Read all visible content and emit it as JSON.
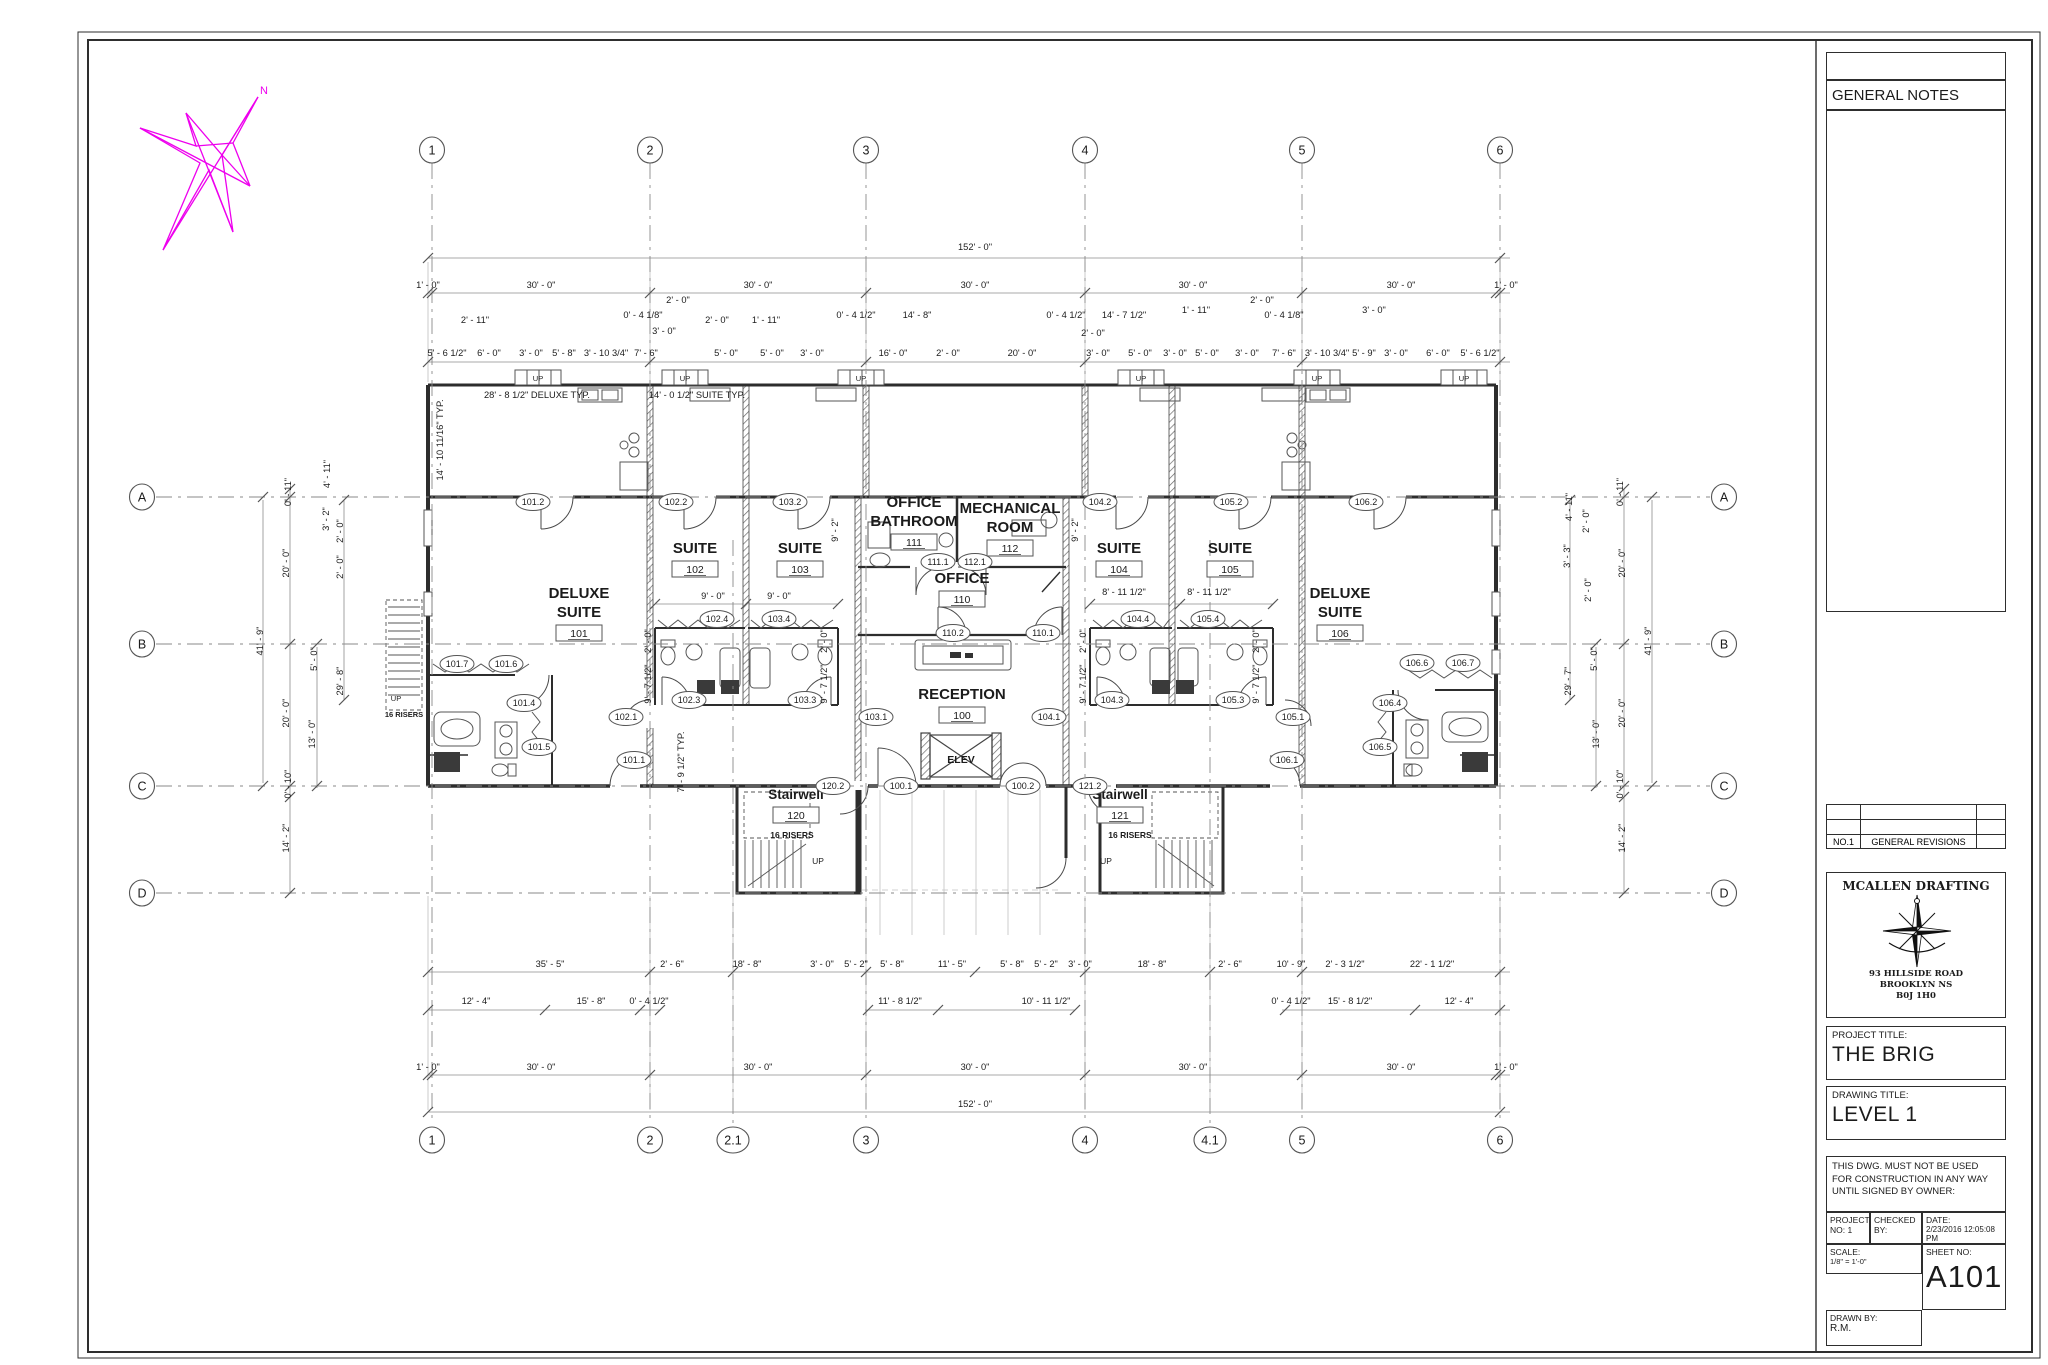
{
  "title_block": {
    "general_notes": "GENERAL NOTES",
    "revisions": {
      "no": "NO.1",
      "desc": "GENERAL REVISIONS"
    },
    "firm": {
      "name": "MCALLEN DRAFTING",
      "address1": "93 HILLSIDE ROAD",
      "address2": "BROOKLYN NS",
      "address3": "B0J 1H0"
    },
    "project_title_label": "PROJECT TITLE:",
    "project_title": "THE BRIG",
    "drawing_title_label": "DRAWING TITLE:",
    "drawing_title": "LEVEL 1",
    "disclaimer": "THIS DWG. MUST NOT BE USED FOR CONSTRUCTION IN ANY WAY UNTIL SIGNED BY OWNER:",
    "project_no_label": "PROJECT NO: 1",
    "checked_by_label": "CHECKED BY:",
    "date_label": "DATE:",
    "date": "2/23/2016 12:05:08 PM",
    "scale_label": "SCALE:",
    "scale": "1/8\" = 1'-0\"",
    "sheet_no_label": "SHEET NO:",
    "sheet_no": "A101",
    "drawn_by_label": "DRAWN BY:",
    "drawn_by": "R.M."
  },
  "plan": {
    "north_label": "N",
    "grid_cols": [
      {
        "label": "1",
        "x": 432
      },
      {
        "label": "2",
        "x": 650
      },
      {
        "label": "2.1",
        "x": 733,
        "bottom_only": true
      },
      {
        "label": "3",
        "x": 866
      },
      {
        "label": "4",
        "x": 1085
      },
      {
        "label": "4.1",
        "x": 1210,
        "bottom_only": true
      },
      {
        "label": "5",
        "x": 1302
      },
      {
        "label": "6",
        "x": 1500
      }
    ],
    "grid_rows": [
      {
        "label": "A",
        "y": 497
      },
      {
        "label": "B",
        "y": 644
      },
      {
        "label": "C",
        "y": 786
      },
      {
        "label": "D",
        "y": 893
      }
    ],
    "rooms": [
      {
        "name": [
          "DELUXE",
          "SUITE"
        ],
        "num": "101",
        "x": 579,
        "y": 598
      },
      {
        "name": [
          "SUITE"
        ],
        "num": "102",
        "x": 695,
        "y": 553
      },
      {
        "name": [
          "SUITE"
        ],
        "num": "103",
        "x": 800,
        "y": 553
      },
      {
        "name": [
          "OFFICE",
          "BATHROOM"
        ],
        "num": "111",
        "x": 914,
        "y": 507
      },
      {
        "name": [
          "MECHANICAL",
          "ROOM"
        ],
        "num": "112",
        "x": 1010,
        "y": 513
      },
      {
        "name": [
          "OFFICE"
        ],
        "num": "110",
        "x": 962,
        "y": 583
      },
      {
        "name": [
          "RECEPTION"
        ],
        "num": "100",
        "x": 962,
        "y": 699
      },
      {
        "name": [
          "SUITE"
        ],
        "num": "104",
        "x": 1119,
        "y": 553
      },
      {
        "name": [
          "SUITE"
        ],
        "num": "105",
        "x": 1230,
        "y": 553
      },
      {
        "name": [
          "DELUXE",
          "SUITE"
        ],
        "num": "106",
        "x": 1340,
        "y": 598
      },
      {
        "name": [
          "Stairwell"
        ],
        "num": "120",
        "x": 796,
        "y": 799,
        "small": true
      },
      {
        "name": [
          "Stairwell"
        ],
        "num": "121",
        "x": 1120,
        "y": 799,
        "small": true
      }
    ],
    "tags": [
      {
        "t": "101.2",
        "x": 533,
        "y": 502
      },
      {
        "t": "102.2",
        "x": 676,
        "y": 502
      },
      {
        "t": "103.2",
        "x": 790,
        "y": 502
      },
      {
        "t": "104.2",
        "x": 1100,
        "y": 502
      },
      {
        "t": "105.2",
        "x": 1231,
        "y": 502
      },
      {
        "t": "106.2",
        "x": 1366,
        "y": 502
      },
      {
        "t": "101.7",
        "x": 457,
        "y": 664
      },
      {
        "t": "101.6",
        "x": 506,
        "y": 664
      },
      {
        "t": "101.4",
        "x": 524,
        "y": 703
      },
      {
        "t": "101.5",
        "x": 539,
        "y": 747
      },
      {
        "t": "101.1",
        "x": 634,
        "y": 760
      },
      {
        "t": "102.1",
        "x": 626,
        "y": 717
      },
      {
        "t": "102.4",
        "x": 717,
        "y": 619
      },
      {
        "t": "103.4",
        "x": 779,
        "y": 619
      },
      {
        "t": "102.3",
        "x": 689,
        "y": 700
      },
      {
        "t": "103.3",
        "x": 805,
        "y": 700
      },
      {
        "t": "111.1",
        "x": 938,
        "y": 562
      },
      {
        "t": "112.1",
        "x": 975,
        "y": 562
      },
      {
        "t": "110.2",
        "x": 953,
        "y": 633
      },
      {
        "t": "110.1",
        "x": 1043,
        "y": 633
      },
      {
        "t": "103.1",
        "x": 876,
        "y": 717
      },
      {
        "t": "104.1",
        "x": 1049,
        "y": 717
      },
      {
        "t": "104.4",
        "x": 1138,
        "y": 619
      },
      {
        "t": "105.4",
        "x": 1208,
        "y": 619
      },
      {
        "t": "104.3",
        "x": 1112,
        "y": 700
      },
      {
        "t": "105.3",
        "x": 1233,
        "y": 700
      },
      {
        "t": "105.1",
        "x": 1293,
        "y": 717
      },
      {
        "t": "106.1",
        "x": 1287,
        "y": 760
      },
      {
        "t": "106.4",
        "x": 1390,
        "y": 703
      },
      {
        "t": "106.5",
        "x": 1380,
        "y": 747
      },
      {
        "t": "106.6",
        "x": 1417,
        "y": 663
      },
      {
        "t": "106.7",
        "x": 1463,
        "y": 663
      },
      {
        "t": "120.2",
        "x": 833,
        "y": 786
      },
      {
        "t": "100.1",
        "x": 901,
        "y": 786
      },
      {
        "t": "100.2",
        "x": 1023,
        "y": 786
      },
      {
        "t": "121.2",
        "x": 1090,
        "y": 786
      }
    ],
    "dims": [
      {
        "t": "152' - 0\"",
        "x": 975,
        "y": 250
      },
      {
        "t": "1' - 0\"",
        "x": 428,
        "y": 288
      },
      {
        "t": "30' - 0\"",
        "x": 541,
        "y": 288
      },
      {
        "t": "30' - 0\"",
        "x": 758,
        "y": 288
      },
      {
        "t": "30' - 0\"",
        "x": 975,
        "y": 288
      },
      {
        "t": "30' - 0\"",
        "x": 1193,
        "y": 288
      },
      {
        "t": "30' - 0\"",
        "x": 1401,
        "y": 288
      },
      {
        "t": "1' - 0\"",
        "x": 1506,
        "y": 288
      },
      {
        "t": "5' - 6 1/2\"",
        "x": 447,
        "y": 356
      },
      {
        "t": "6' - 0\"",
        "x": 489,
        "y": 356
      },
      {
        "t": "3' - 0\"",
        "x": 531,
        "y": 356
      },
      {
        "t": "5' - 8\"",
        "x": 564,
        "y": 356
      },
      {
        "t": "3' - 10 3/4\"",
        "x": 606,
        "y": 356
      },
      {
        "t": "7' - 6\"",
        "x": 646,
        "y": 356
      },
      {
        "t": "5' - 0\"",
        "x": 726,
        "y": 356
      },
      {
        "t": "5' - 0\"",
        "x": 772,
        "y": 356
      },
      {
        "t": "3' - 0\"",
        "x": 812,
        "y": 356
      },
      {
        "t": "16' - 0\"",
        "x": 893,
        "y": 356
      },
      {
        "t": "2' - 0\"",
        "x": 948,
        "y": 356
      },
      {
        "t": "20' - 0\"",
        "x": 1022,
        "y": 356
      },
      {
        "t": "3' - 0\"",
        "x": 1098,
        "y": 356
      },
      {
        "t": "5' - 0\"",
        "x": 1140,
        "y": 356
      },
      {
        "t": "3' - 0\"",
        "x": 1175,
        "y": 356
      },
      {
        "t": "5' - 0\"",
        "x": 1207,
        "y": 356
      },
      {
        "t": "3' - 0\"",
        "x": 1247,
        "y": 356
      },
      {
        "t": "7' - 6\"",
        "x": 1284,
        "y": 356
      },
      {
        "t": "3' - 10 3/4\"",
        "x": 1327,
        "y": 356
      },
      {
        "t": "5' - 9\"",
        "x": 1364,
        "y": 356
      },
      {
        "t": "3' - 0\"",
        "x": 1396,
        "y": 356
      },
      {
        "t": "6' - 0\"",
        "x": 1438,
        "y": 356
      },
      {
        "t": "5' - 6 1/2\"",
        "x": 1480,
        "y": 356
      },
      {
        "t": "2' - 11\"",
        "x": 475,
        "y": 323
      },
      {
        "t": "0' - 4 1/8\"",
        "x": 643,
        "y": 318
      },
      {
        "t": "2' - 0\"",
        "x": 678,
        "y": 303
      },
      {
        "t": "3' - 0\"",
        "x": 664,
        "y": 334
      },
      {
        "t": "2' - 0\"",
        "x": 717,
        "y": 323
      },
      {
        "t": "1' - 11\"",
        "x": 766,
        "y": 323
      },
      {
        "t": "0' - 4 1/2\"",
        "x": 856,
        "y": 318
      },
      {
        "t": "14' - 8\"",
        "x": 917,
        "y": 318
      },
      {
        "t": "0' - 4 1/2\"",
        "x": 1066,
        "y": 318
      },
      {
        "t": "14' - 7 1/2\"",
        "x": 1124,
        "y": 318
      },
      {
        "t": "2' - 0\"",
        "x": 1093,
        "y": 336
      },
      {
        "t": "1' - 11\"",
        "x": 1196,
        "y": 313
      },
      {
        "t": "2' - 0\"",
        "x": 1262,
        "y": 303
      },
      {
        "t": "0' - 4 1/8\"",
        "x": 1284,
        "y": 318
      },
      {
        "t": "3' - 0\"",
        "x": 1374,
        "y": 313
      },
      {
        "t": "28' - 8 1/2\" DELUXE TYP.",
        "x": 537,
        "y": 398
      },
      {
        "t": "14' - 0 1/2\" SUITE TYP.",
        "x": 697,
        "y": 398
      },
      {
        "t": "14' - 10 11/16\" TYP.",
        "x": 443,
        "y": 440,
        "r": 1
      },
      {
        "t": "9' - 0\"",
        "x": 713,
        "y": 599
      },
      {
        "t": "9' - 0\"",
        "x": 779,
        "y": 599
      },
      {
        "t": "8' - 11 1/2\"",
        "x": 1124,
        "y": 595
      },
      {
        "t": "8' - 11 1/2\"",
        "x": 1209,
        "y": 595
      },
      {
        "t": "2' - 0\"",
        "x": 651,
        "y": 641,
        "r": 1
      },
      {
        "t": "2' - 0\"",
        "x": 827,
        "y": 641,
        "r": 1
      },
      {
        "t": "2' - 0\"",
        "x": 1086,
        "y": 641,
        "r": 1
      },
      {
        "t": "2' - 0\"",
        "x": 1259,
        "y": 641,
        "r": 1
      },
      {
        "t": "9' - 7 1/2\"",
        "x": 651,
        "y": 684,
        "r": 1
      },
      {
        "t": "9' - 7 1/2\"",
        "x": 827,
        "y": 684,
        "r": 1
      },
      {
        "t": "9' - 7 1/2\"",
        "x": 1086,
        "y": 684,
        "r": 1
      },
      {
        "t": "9' - 7 1/2\"",
        "x": 1259,
        "y": 684,
        "r": 1
      },
      {
        "t": "7' - 9 1/2\" TYP.",
        "x": 684,
        "y": 762,
        "r": 1
      },
      {
        "t": "9' - 2\"",
        "x": 838,
        "y": 530,
        "r": 1
      },
      {
        "t": "9' - 2\"",
        "x": 1078,
        "y": 530,
        "r": 1
      },
      {
        "t": "0' - 11\"",
        "x": 291,
        "y": 492,
        "r": 1
      },
      {
        "t": "20' - 0\"",
        "x": 289,
        "y": 563,
        "r": 1
      },
      {
        "t": "41' - 9\"",
        "x": 263,
        "y": 641,
        "r": 1
      },
      {
        "t": "20' - 0\"",
        "x": 289,
        "y": 713,
        "r": 1
      },
      {
        "t": "0' - 10\"",
        "x": 291,
        "y": 784,
        "r": 1
      },
      {
        "t": "14' - 2\"",
        "x": 289,
        "y": 838,
        "r": 1
      },
      {
        "t": "5' - 0\"",
        "x": 317,
        "y": 659,
        "r": 1
      },
      {
        "t": "13' - 0\"",
        "x": 315,
        "y": 734,
        "r": 1
      },
      {
        "t": "29' - 8\"",
        "x": 343,
        "y": 681,
        "r": 1
      },
      {
        "t": "4' - 11\"",
        "x": 330,
        "y": 474,
        "r": 1
      },
      {
        "t": "3' - 2\"",
        "x": 329,
        "y": 519,
        "r": 1
      },
      {
        "t": "2' - 0\"",
        "x": 343,
        "y": 531,
        "r": 1
      },
      {
        "t": "2' - 0\"",
        "x": 343,
        "y": 567,
        "r": 1
      },
      {
        "t": "0' - 11\"",
        "x": 1623,
        "y": 492,
        "r": 1
      },
      {
        "t": "20' - 0\"",
        "x": 1625,
        "y": 563,
        "r": 1
      },
      {
        "t": "41' - 9\"",
        "x": 1651,
        "y": 641,
        "r": 1
      },
      {
        "t": "20' - 0\"",
        "x": 1625,
        "y": 713,
        "r": 1
      },
      {
        "t": "0' - 10\"",
        "x": 1623,
        "y": 784,
        "r": 1
      },
      {
        "t": "14' - 2\"",
        "x": 1625,
        "y": 838,
        "r": 1
      },
      {
        "t": "5' - 0\"",
        "x": 1597,
        "y": 659,
        "r": 1
      },
      {
        "t": "13' - 0\"",
        "x": 1599,
        "y": 734,
        "r": 1
      },
      {
        "t": "29' - 7\"",
        "x": 1571,
        "y": 681,
        "r": 1
      },
      {
        "t": "4' - 11\"",
        "x": 1572,
        "y": 507,
        "r": 1
      },
      {
        "t": "2' - 0\"",
        "x": 1589,
        "y": 521,
        "r": 1
      },
      {
        "t": "3' - 3\"",
        "x": 1570,
        "y": 556,
        "r": 1
      },
      {
        "t": "2' - 0\"",
        "x": 1591,
        "y": 590,
        "r": 1
      },
      {
        "t": "35' - 5\"",
        "x": 550,
        "y": 967
      },
      {
        "t": "2' - 6\"",
        "x": 672,
        "y": 967
      },
      {
        "t": "18' - 8\"",
        "x": 747,
        "y": 967
      },
      {
        "t": "3' - 0\"",
        "x": 822,
        "y": 967
      },
      {
        "t": "5' - 2\"",
        "x": 856,
        "y": 967
      },
      {
        "t": "5' - 8\"",
        "x": 892,
        "y": 967
      },
      {
        "t": "11' - 5\"",
        "x": 952,
        "y": 967
      },
      {
        "t": "5' - 8\"",
        "x": 1012,
        "y": 967
      },
      {
        "t": "5' - 2\"",
        "x": 1046,
        "y": 967
      },
      {
        "t": "3' - 0\"",
        "x": 1080,
        "y": 967
      },
      {
        "t": "18' - 8\"",
        "x": 1152,
        "y": 967
      },
      {
        "t": "2' - 6\"",
        "x": 1230,
        "y": 967
      },
      {
        "t": "10' - 9\"",
        "x": 1291,
        "y": 967
      },
      {
        "t": "2' - 3 1/2\"",
        "x": 1345,
        "y": 967
      },
      {
        "t": "22' - 1 1/2\"",
        "x": 1432,
        "y": 967
      },
      {
        "t": "12' - 4\"",
        "x": 476,
        "y": 1004
      },
      {
        "t": "15' - 8\"",
        "x": 591,
        "y": 1004
      },
      {
        "t": "0' - 4 1/2\"",
        "x": 649,
        "y": 1004
      },
      {
        "t": "11' - 8 1/2\"",
        "x": 900,
        "y": 1004
      },
      {
        "t": "10' - 11 1/2\"",
        "x": 1046,
        "y": 1004
      },
      {
        "t": "0' - 4 1/2\"",
        "x": 1291,
        "y": 1004
      },
      {
        "t": "15' - 8 1/2\"",
        "x": 1350,
        "y": 1004
      },
      {
        "t": "12' - 4\"",
        "x": 1459,
        "y": 1004
      },
      {
        "t": "1' - 0\"",
        "x": 428,
        "y": 1070
      },
      {
        "t": "30' - 0\"",
        "x": 541,
        "y": 1070
      },
      {
        "t": "30' - 0\"",
        "x": 758,
        "y": 1070
      },
      {
        "t": "30' - 0\"",
        "x": 975,
        "y": 1070
      },
      {
        "t": "30' - 0\"",
        "x": 1193,
        "y": 1070
      },
      {
        "t": "30' - 0\"",
        "x": 1401,
        "y": 1070
      },
      {
        "t": "1' - 0\"",
        "x": 1506,
        "y": 1070
      },
      {
        "t": "152' - 0\"",
        "x": 975,
        "y": 1107
      }
    ],
    "texts": [
      {
        "t": "16 RISERS",
        "x": 792,
        "y": 838,
        "s": 8.5
      },
      {
        "t": "16  RISERS",
        "x": 1130,
        "y": 838,
        "s": 8.5
      },
      {
        "t": "16 RISERS",
        "x": 404,
        "y": 717,
        "s": 7.5
      },
      {
        "t": "UP",
        "x": 818,
        "y": 864,
        "s": 8.5
      },
      {
        "t": "UP",
        "x": 1106,
        "y": 864,
        "s": 8.5
      },
      {
        "t": "UP",
        "x": 396,
        "y": 701,
        "s": 7.5
      },
      {
        "t": "ELEV",
        "x": 961,
        "y": 763,
        "s": 10.5
      },
      {
        "t": "UP",
        "x": 538,
        "y": 381,
        "s": 7.5
      },
      {
        "t": "UP",
        "x": 685,
        "y": 381,
        "s": 7.5
      },
      {
        "t": "UP",
        "x": 861,
        "y": 381,
        "s": 7.5
      },
      {
        "t": "UP",
        "x": 1141,
        "y": 381,
        "s": 7.5
      },
      {
        "t": "UP",
        "x": 1317,
        "y": 381,
        "s": 7.5
      },
      {
        "t": "UP",
        "x": 1464,
        "y": 381,
        "s": 7.5
      }
    ]
  }
}
